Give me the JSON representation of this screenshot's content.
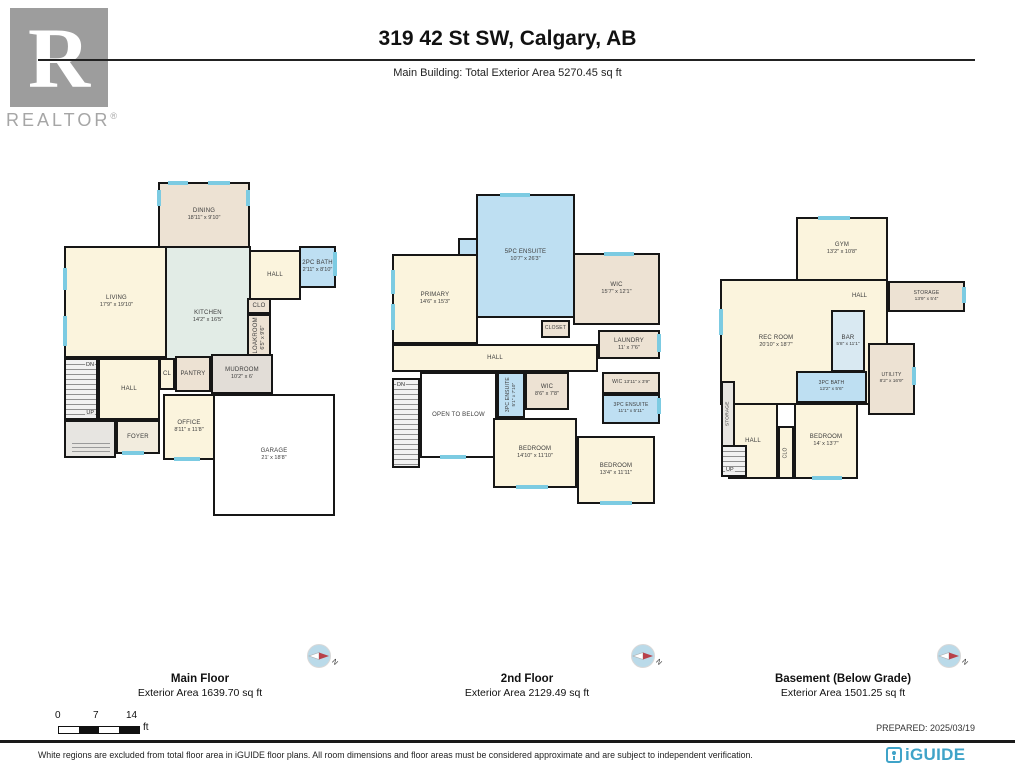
{
  "header": {
    "logo_text": "REALTOR",
    "logo_reg": "®",
    "logo_r": "R",
    "title": "319 42 St SW, Calgary, AB",
    "subtitle": "Main Building: Total Exterior Area 5270.45 sq ft"
  },
  "plans": {
    "main": {
      "caption": "Main Floor",
      "area": "Exterior Area 1639.70 sq ft",
      "rooms": {
        "dining": {
          "name": "DINING",
          "dims": "18'11\" x 9'10\""
        },
        "living": {
          "name": "LIVING",
          "dims": "17'9\" x 19'10\""
        },
        "kitchen": {
          "name": "KITCHEN",
          "dims": "14'2\" x 16'5\""
        },
        "hall_upper": {
          "name": "HALL"
        },
        "bath": {
          "name": "2PC BATH",
          "dims": "2'11\" x 8'10\""
        },
        "clo": {
          "name": "CLO"
        },
        "cloakroom": {
          "name": "CLOAKROOM",
          "dims": "6'5\" x 9'6\""
        },
        "cl": {
          "name": "CL"
        },
        "pantry": {
          "name": "PANTRY"
        },
        "mudroom": {
          "name": "MUDROOM",
          "dims": "10'2\" x 6'"
        },
        "hall_center": {
          "name": "HALL"
        },
        "foyer": {
          "name": "FOYER"
        },
        "office": {
          "name": "OFFICE",
          "dims": "8'11\" x 11'8\""
        },
        "garage": {
          "name": "GARAGE",
          "dims": "21' x 18'8\""
        },
        "dn": {
          "name": "DN"
        },
        "up": {
          "name": "UP"
        }
      }
    },
    "second": {
      "caption": "2nd Floor",
      "area": "Exterior Area 2129.49 sq ft",
      "rooms": {
        "primary": {
          "name": "PRIMARY",
          "dims": "14'6\" x 15'3\""
        },
        "ensuite5": {
          "name": "5PC ENSUITE",
          "dims": "10'7\" x 26'3\""
        },
        "wic_primary": {
          "name": "WIC",
          "dims": "15'7\" x 12'1\""
        },
        "closet": {
          "name": "CLOSET"
        },
        "laundry": {
          "name": "LAUNDRY",
          "dims": "11' x 7'6\""
        },
        "hall": {
          "name": "HALL"
        },
        "open_below": {
          "name": "OPEN TO BELOW"
        },
        "ensuite3_center": {
          "name": "3PC ENSUITE",
          "dims": "5'1\" x 7'10\""
        },
        "wic_center": {
          "name": "WIC",
          "dims": "8'6\" x 7'8\""
        },
        "bedroom_center": {
          "name": "BEDROOM",
          "dims": "14'10\" x 11'10\""
        },
        "wic_right": {
          "name": "WIC",
          "dims": "13'11\" x 3'9\""
        },
        "ensuite3_right": {
          "name": "3PC ENSUITE",
          "dims": "11'1\" x 5'11\""
        },
        "bedroom_right": {
          "name": "BEDROOM",
          "dims": "13'4\" x 11'11\""
        },
        "dn": {
          "name": "DN"
        }
      }
    },
    "basement": {
      "caption": "Basement (Below Grade)",
      "area": "Exterior Area 1501.25 sq ft",
      "rooms": {
        "gym": {
          "name": "GYM",
          "dims": "13'2\" x 10'8\""
        },
        "storage": {
          "name": "STORAGE",
          "dims": "13'9\" x 5'4\""
        },
        "hall_upper": {
          "name": "HALL"
        },
        "rec": {
          "name": "REC ROOM",
          "dims": "20'10\" x 18'7\""
        },
        "bar": {
          "name": "BAR",
          "dims": "5'8\" x 11'1\""
        },
        "utility": {
          "name": "UTILITY",
          "dims": "8'2\" x 16'9\""
        },
        "bath": {
          "name": "3PC BATH",
          "dims": "12'2\" x 5'6\""
        },
        "bedroom": {
          "name": "BEDROOM",
          "dims": "14' x 13'7\""
        },
        "clo": {
          "name": "CLO"
        },
        "hall_lower": {
          "name": "HALL"
        },
        "storage_v": {
          "name": "STORAGE"
        },
        "up": {
          "name": "UP"
        }
      }
    }
  },
  "compass": {
    "north_label": "N"
  },
  "scale_bar": {
    "t0": "0",
    "t1": "7",
    "t2": "14",
    "unit": "ft"
  },
  "prepared": "PREPARED: 2025/03/19",
  "footer": {
    "disclaimer": "White regions are excluded from total floor area in iGUIDE floor plans. All room dimensions and floor areas must be considered approximate and are subject to independent verification.",
    "brand": "iGUIDE"
  },
  "colors": {
    "brand_teal": "#3FA3C8",
    "window_teal": "#7CCBE2",
    "wall_black": "#161616",
    "room_cream": "#FBF4DD",
    "room_tan": "#EDE2D3",
    "room_green": "#E2ECE6",
    "room_blue": "#BEDFF2",
    "logo_gray": "#9D9D9D"
  }
}
